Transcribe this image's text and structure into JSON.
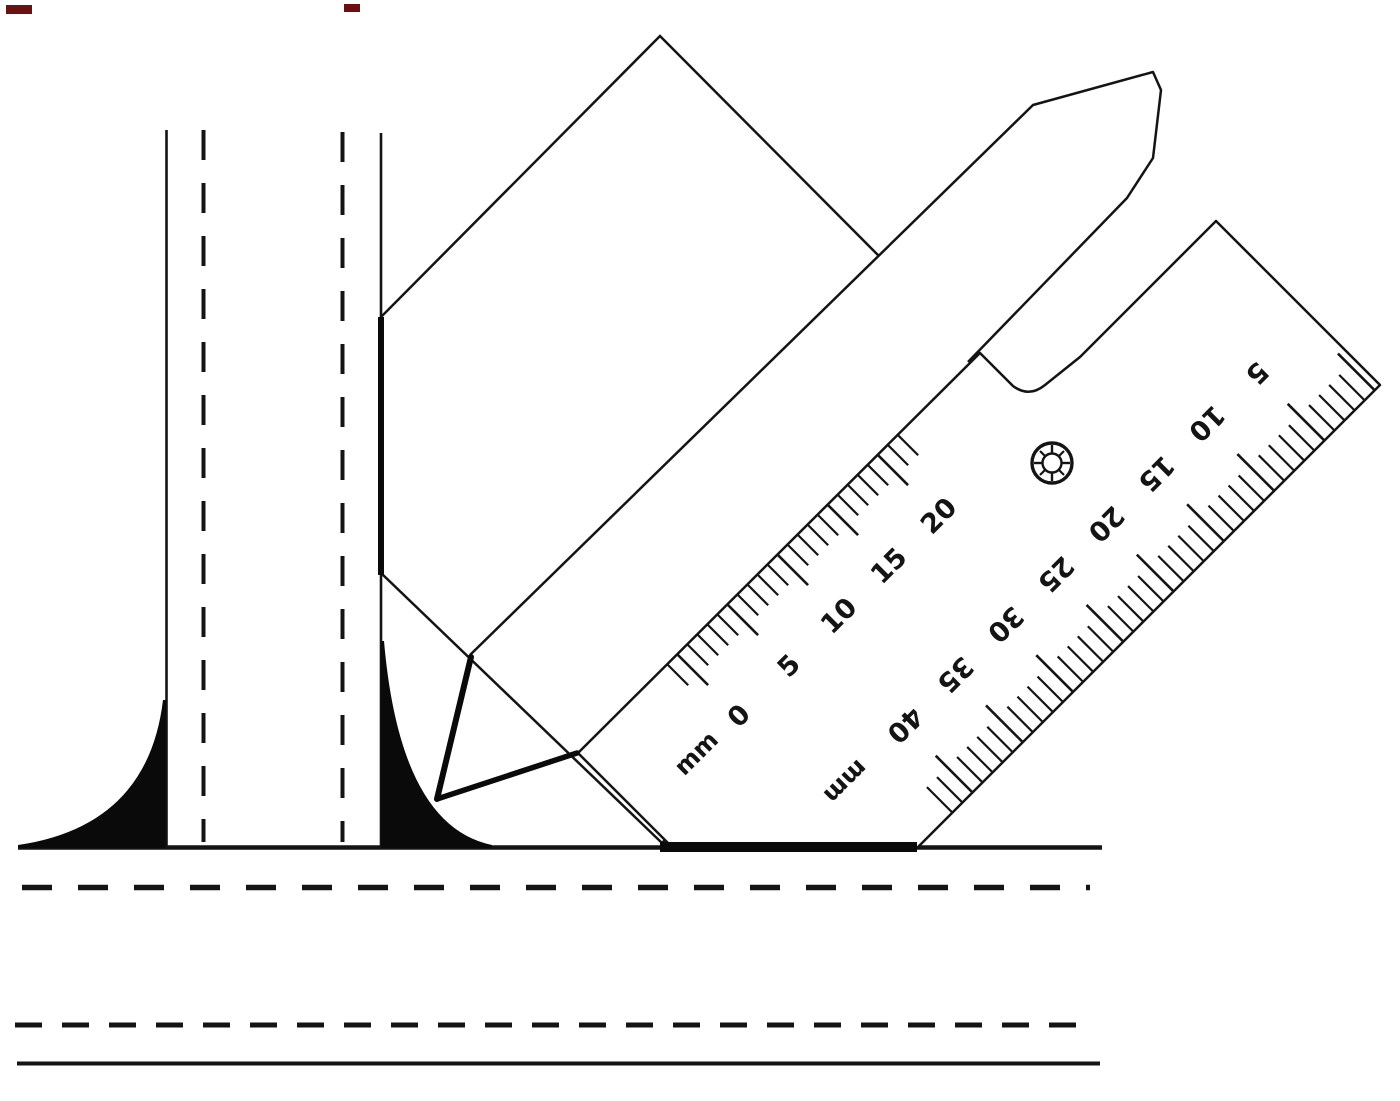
{
  "colors": {
    "ink": "#141414",
    "paper": "#ffffff",
    "weld_fill": "#0a0a0a",
    "artifact_red": "#6b1111"
  },
  "gauge_ruler": {
    "inner_scale": {
      "unit": "mm",
      "tick_interval_mm": 1,
      "major_tick_every_mm": 5,
      "tick_range_mm": [
        -1,
        22
      ],
      "labels": [
        {
          "mm": 0,
          "text": "0"
        },
        {
          "mm": 5,
          "text": "5"
        },
        {
          "mm": 10,
          "text": "10"
        },
        {
          "mm": 15,
          "text": "15"
        },
        {
          "mm": 20,
          "text": "20"
        }
      ]
    },
    "outer_scale": {
      "unit": "mm",
      "tick_interval_mm": 1,
      "major_tick_every_mm": 5,
      "tick_range_mm": [
        0,
        42
      ],
      "labels": [
        {
          "mm": 40,
          "text": "40"
        },
        {
          "mm": 35,
          "text": "35"
        },
        {
          "mm": 30,
          "text": "30"
        },
        {
          "mm": 25,
          "text": "25"
        },
        {
          "mm": 20,
          "text": "20"
        },
        {
          "mm": 15,
          "text": "15"
        },
        {
          "mm": 10,
          "text": "10"
        },
        {
          "mm": 5,
          "text": "5"
        }
      ]
    }
  }
}
